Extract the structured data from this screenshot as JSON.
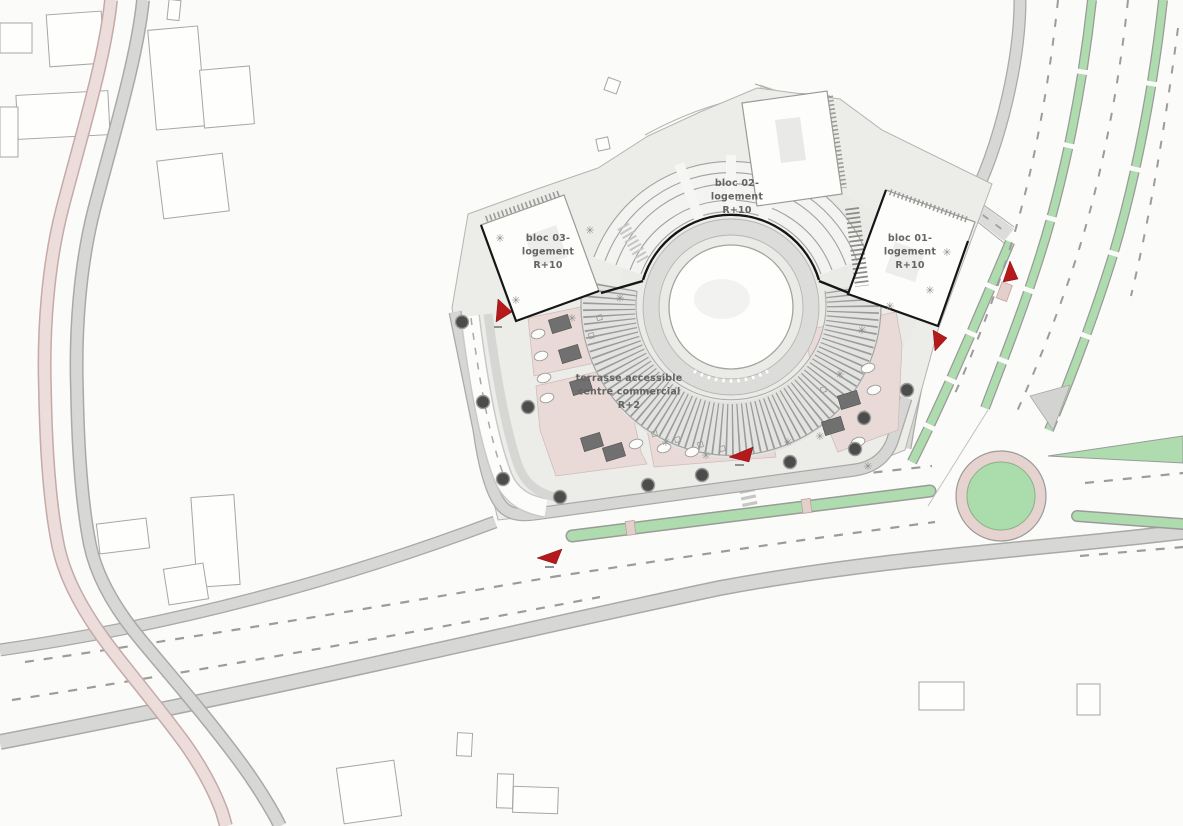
{
  "plan": {
    "type": "architectural site plan",
    "labels": {
      "bloc_01": {
        "line1": "bloc 01-",
        "line2": "logement",
        "line3": "R+10"
      },
      "bloc_02": {
        "line1": "bloc 02-",
        "line2": "logement",
        "line3": "R+10"
      },
      "bloc_03": {
        "line1": "bloc 03-",
        "line2": "logement",
        "line3": "R+10"
      },
      "terrasse": {
        "line1": "terrasse accessible",
        "line2": "centre commercial",
        "line3": "R+2"
      }
    },
    "icons": {
      "shrub_glyph": "✳",
      "tree_icon": "dark circle",
      "entrance_arrow_icon": "red triangle"
    },
    "colors": {
      "background": "#fbfbfa",
      "site_fill": "#ecece9",
      "sidewalk_gray": "#d7d7d5",
      "curb_gray": "#a9a9a7",
      "road_white": "#fcfcfb",
      "lane_dash_gray": "#9c9c9a",
      "median_green": "#aedcae",
      "roundabout_green": "#abdcab",
      "roundabout_ring_pink": "#e6d2ce",
      "terrace_pink": "#e9dad7",
      "left_road_pink": "#ecdcda",
      "building_white": "#fdfdfc",
      "building_outline": "#9a9a98",
      "bold_outline_black": "#161616",
      "planter_gray": "#707070",
      "tree_dark": "#4c4c4c",
      "entrance_arrow_red": "#b5191c",
      "label_gray": "#646462"
    }
  }
}
